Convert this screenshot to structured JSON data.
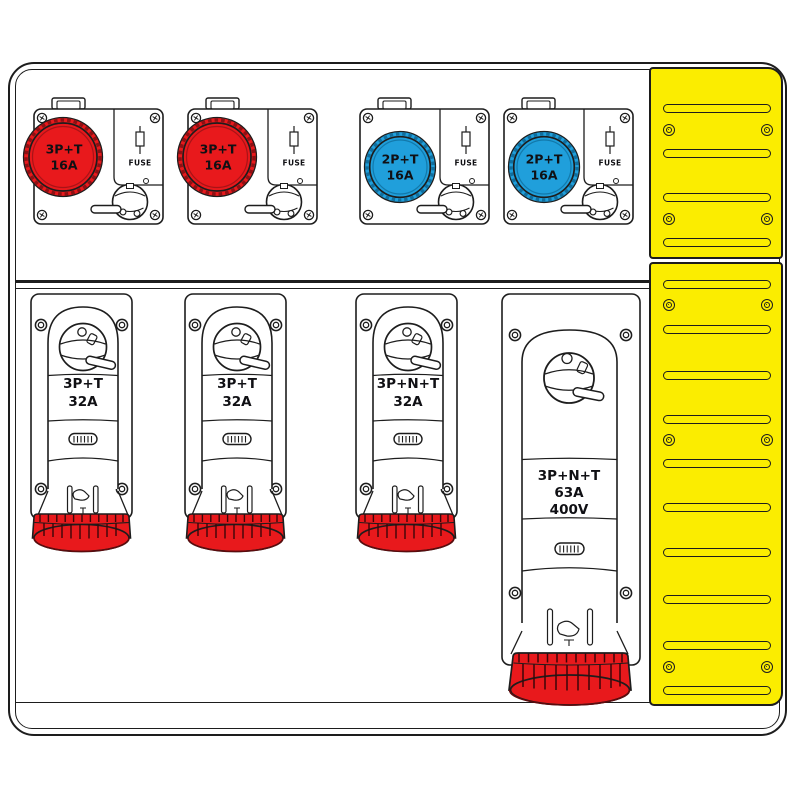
{
  "board_name": "industrial distribution board",
  "colors": {
    "red": "#e8191c",
    "blue": "#209fdb",
    "yellow": "#fbed00",
    "line": "#1d1d1d"
  },
  "top_row": [
    {
      "label_line1": "3P+T",
      "label_line2": "16A",
      "fuse_label": "FUSE",
      "color": "red"
    },
    {
      "label_line1": "3P+T",
      "label_line2": "16A",
      "fuse_label": "FUSE",
      "color": "red"
    },
    {
      "label_line1": "2P+T",
      "label_line2": "16A",
      "fuse_label": "FUSE",
      "color": "blue"
    },
    {
      "label_line1": "2P+T",
      "label_line2": "16A",
      "fuse_label": "FUSE",
      "color": "blue"
    }
  ],
  "bottom_row": [
    {
      "label_line1": "3P+T",
      "label_line2": "32A"
    },
    {
      "label_line1": "3P+T",
      "label_line2": "32A"
    },
    {
      "label_line1": "3P+N+T",
      "label_line2": "32A"
    },
    {
      "label_line1": "3P+N+T",
      "label_line2": "63A",
      "label_line3": "400V"
    }
  ]
}
